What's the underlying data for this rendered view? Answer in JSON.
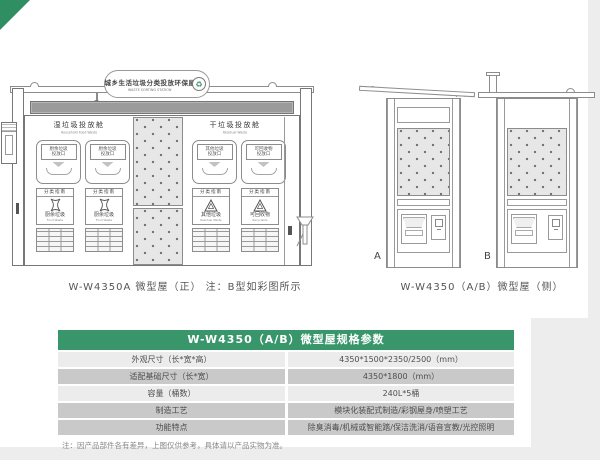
{
  "page": {
    "accent_green": "#38966a",
    "corner_ribbon_green": "#2f8f63",
    "table_row_light": "#ececec",
    "table_row_dark": "#c9c9c9"
  },
  "front": {
    "banner_cn": "城乡生活垃圾分类投放环保屋",
    "banner_en": "WASTE SORTING STATION",
    "wet": {
      "title_cn": "湿垃圾投放舱",
      "title_en": "Household Food Waste",
      "door1_line1": "厨余垃圾",
      "door1_line2": "投放口",
      "door2_line1": "厨余垃圾",
      "door2_line2": "投放口",
      "sign_header": "分类指南",
      "sign1_cn": "厨余垃圾",
      "sign1_en": "Food Waste",
      "sign2_cn": "厨余垃圾",
      "sign2_en": "Food Waste"
    },
    "dry": {
      "title_cn": "干垃圾投放舱",
      "title_en": "Residual Waste",
      "door1_line1": "其他垃圾",
      "door1_line2": "投放口",
      "door2_line1": "可回收物",
      "door2_line2": "投放口",
      "sign_header": "分类指南",
      "sign1_cn": "其他垃圾",
      "sign1_en": "Residual Waste",
      "sign2_cn": "可回收物",
      "sign2_en": "Recyclable"
    },
    "caption": "W-W4350A 微型屋（正）  注：B型如彩图所示"
  },
  "side": {
    "label_a": "A",
    "label_b": "B",
    "caption": "W-W4350（A/B）微型屋（侧）"
  },
  "table": {
    "title": "W-W4350（A/B）微型屋规格参数",
    "rows": [
      {
        "label": "外观尺寸（长*宽*高）",
        "value": "4350*1500*2350/2500（mm）"
      },
      {
        "label": "适配基础尺寸（长*宽）",
        "value": "4350*1800（mm）"
      },
      {
        "label": "容量（桶数）",
        "value": "240L*5桶"
      },
      {
        "label": "制造工艺",
        "value": "模块化装配式制造/彩钢屋身/喷塑工艺"
      },
      {
        "label": "功能特点",
        "value": "除臭消毒/机械或智能踏/保洁洗消/语音宣教/光控照明"
      }
    ],
    "footnote": "注：因产品部件各有差异，上图仅供参考，具体请以产品实物为准。"
  },
  "icons": {
    "banner_logo": "recycle-logo-icon",
    "wet_sign": "food-waste-icon",
    "dry_sign": "recyclable-icon"
  }
}
